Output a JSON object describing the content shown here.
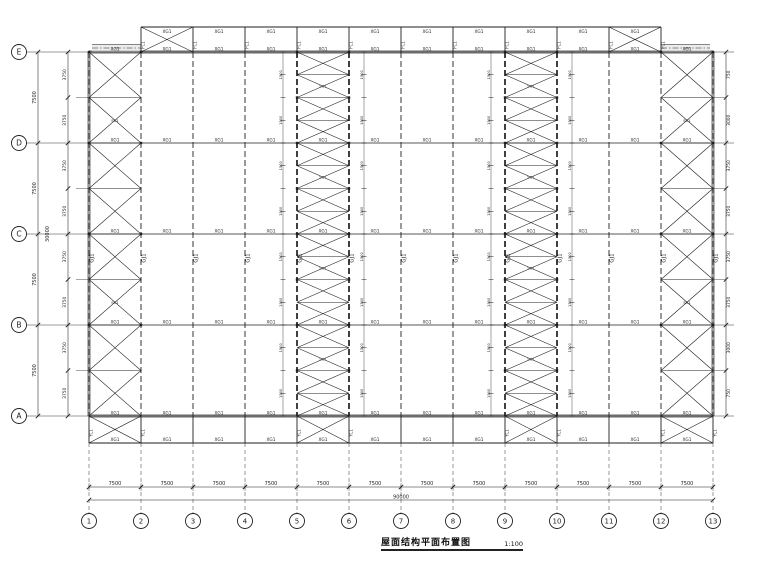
{
  "drawing": {
    "title": "屋面结构平面布置图",
    "scale": "1:100"
  },
  "grids": {
    "rows": [
      "E",
      "D",
      "C",
      "B",
      "A"
    ],
    "cols": [
      "1",
      "2",
      "3",
      "4",
      "5",
      "6",
      "7",
      "8",
      "9",
      "10",
      "11",
      "12",
      "13"
    ]
  },
  "dimensions": {
    "bottom_bays": [
      "7500",
      "7500",
      "7500",
      "7500",
      "7500",
      "7500",
      "7500",
      "7500",
      "7500",
      "7500",
      "7500",
      "7500"
    ],
    "bottom_total": "90000",
    "left_outer_bays": [
      "7500",
      "7500",
      "7500",
      "7500"
    ],
    "left_total": "30000",
    "left_inner_segments": [
      "3750",
      "3750",
      "3750",
      "3750",
      "3750",
      "3750",
      "3750",
      "3750"
    ],
    "right_segments": [
      "750",
      "3000",
      "3750",
      "3750",
      "3750",
      "3750",
      "3000",
      "750"
    ],
    "brace_panel": "1500"
  },
  "members": {
    "frame": "GJ1",
    "tie": "XG1",
    "brace": "SC1",
    "column_brace": "YC1",
    "band_post": "FC1"
  },
  "structure": {
    "full_braced_bays": [
      {
        "bay": 0,
        "panels": 8
      },
      {
        "bay": 4,
        "panels": 16
      },
      {
        "bay": 8,
        "panels": 16
      },
      {
        "bay": 11,
        "panels": 8
      }
    ],
    "top_band_braced_bays": [
      1,
      10
    ],
    "lower_band_braced_bays": [
      0,
      4,
      8,
      11
    ]
  },
  "colors": {
    "line": "#1f1f1f",
    "heavy": "#9a9a9a",
    "strip": "#e2e2e2",
    "bg": "#ffffff"
  }
}
